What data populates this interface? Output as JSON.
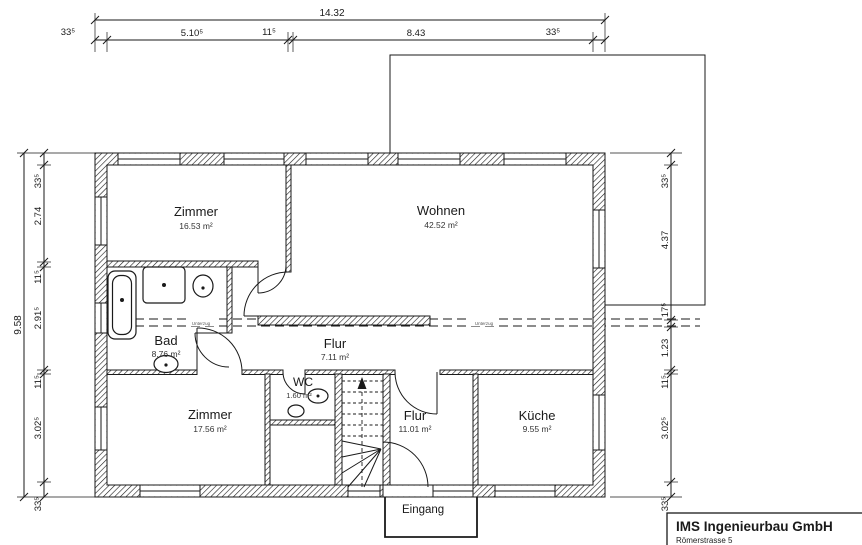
{
  "dimensions": {
    "top": {
      "overall": "14.32",
      "chain": [
        "33⁵",
        "5.10⁵",
        "11⁵",
        "8.43",
        "33⁵"
      ]
    },
    "left": {
      "overall": "9.58",
      "chain": [
        "33⁵",
        "2.74",
        "11⁵",
        "2.91⁵",
        "11⁵",
        "3.02⁵",
        "33⁵"
      ]
    },
    "right": {
      "chain": [
        "33⁵",
        "4.37",
        "17⁵",
        "1.23",
        "11⁵",
        "3.02⁵",
        "33⁵"
      ]
    }
  },
  "rooms": {
    "zimmer1": {
      "name": "Zimmer",
      "area": "16.53 m²"
    },
    "wohnen": {
      "name": "Wohnen",
      "area": "42.52 m²"
    },
    "bad": {
      "name": "Bad",
      "area": "8.76 m²"
    },
    "flur1": {
      "name": "Flur",
      "area": "7.11 m²"
    },
    "wc": {
      "name": "WC",
      "area": "1.60 m²"
    },
    "zimmer2": {
      "name": "Zimmer",
      "area": "17.56 m²"
    },
    "flur2": {
      "name": "Flur",
      "area": "11.01 m²"
    },
    "kueche": {
      "name": "Küche",
      "area": "9.55 m²"
    }
  },
  "annotations": {
    "eingang": "Eingang",
    "unterzug": "Unterzug"
  },
  "title_block": {
    "company": "IMS Ingenieurbau GmbH",
    "address": "Römerstrasse 5"
  },
  "colors": {
    "line": "#1a1a1a",
    "background": "#ffffff"
  }
}
